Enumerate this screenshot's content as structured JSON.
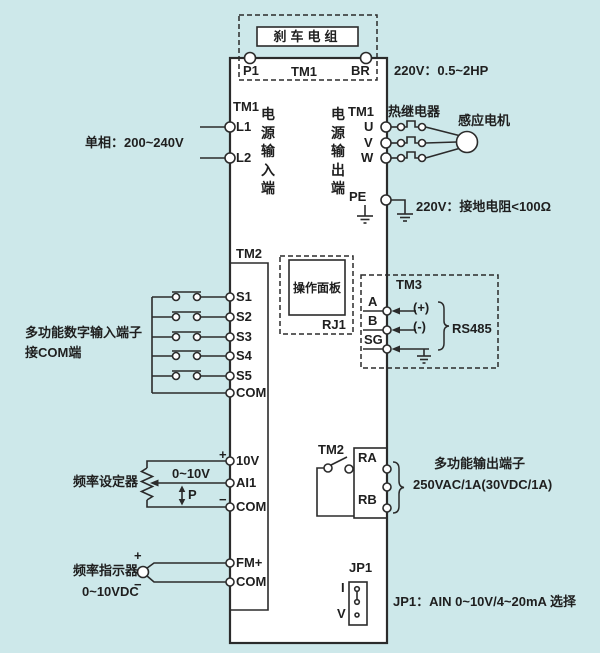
{
  "colors": {
    "background": "#cde8ea",
    "line": "#2b2b2b",
    "box_fill": "#ffffff"
  },
  "brake": {
    "box_label": "刹车电组",
    "p1": "P1",
    "tm1": "TM1",
    "br": "BR",
    "rating": "220V：0.5~2HP"
  },
  "input": {
    "tm1": "TM1",
    "l1": "L1",
    "l2": "L2",
    "phase": "单相：200~240V",
    "col": "电源输入端"
  },
  "output": {
    "tm1": "TM1",
    "u": "U",
    "v": "V",
    "w": "W",
    "col": "电源输出端",
    "relay": "热继电器",
    "motor": "感应电机"
  },
  "ground": {
    "pe": "PE",
    "note": "220V：接地电阻<100Ω"
  },
  "digital": {
    "tm2": "TM2",
    "terminals": [
      "S1",
      "S2",
      "S3",
      "S4",
      "S5",
      "COM"
    ],
    "note1": "多功能数字输入端子",
    "note2": "接COM端"
  },
  "panel": {
    "label": "操作面板",
    "rj1": "RJ1"
  },
  "comm": {
    "tm3": "TM3",
    "a": "A",
    "b": "B",
    "sg": "SG",
    "plus": "(+)",
    "minus": "(-)",
    "bus": "RS485"
  },
  "analog": {
    "v10": "10V",
    "ai1": "AI1",
    "com": "COM",
    "plus": "+",
    "minus": "−",
    "range": "0~10V",
    "p": "P",
    "setter": "频率设定器"
  },
  "relay_out": {
    "tm2": "TM2",
    "ra": "RA",
    "rb": "RB",
    "note1": "多功能输出端子",
    "note2": "250VAC/1A(30VDC/1A)"
  },
  "meter": {
    "fm": "FM+",
    "com": "COM",
    "plus": "+",
    "minus": "−",
    "label": "频率指示器",
    "range": "0~10VDC"
  },
  "jumper": {
    "jp1": "JP1",
    "i": "I",
    "v": "V",
    "note": "JP1：AIN 0~10V/4~20mA 选择"
  }
}
